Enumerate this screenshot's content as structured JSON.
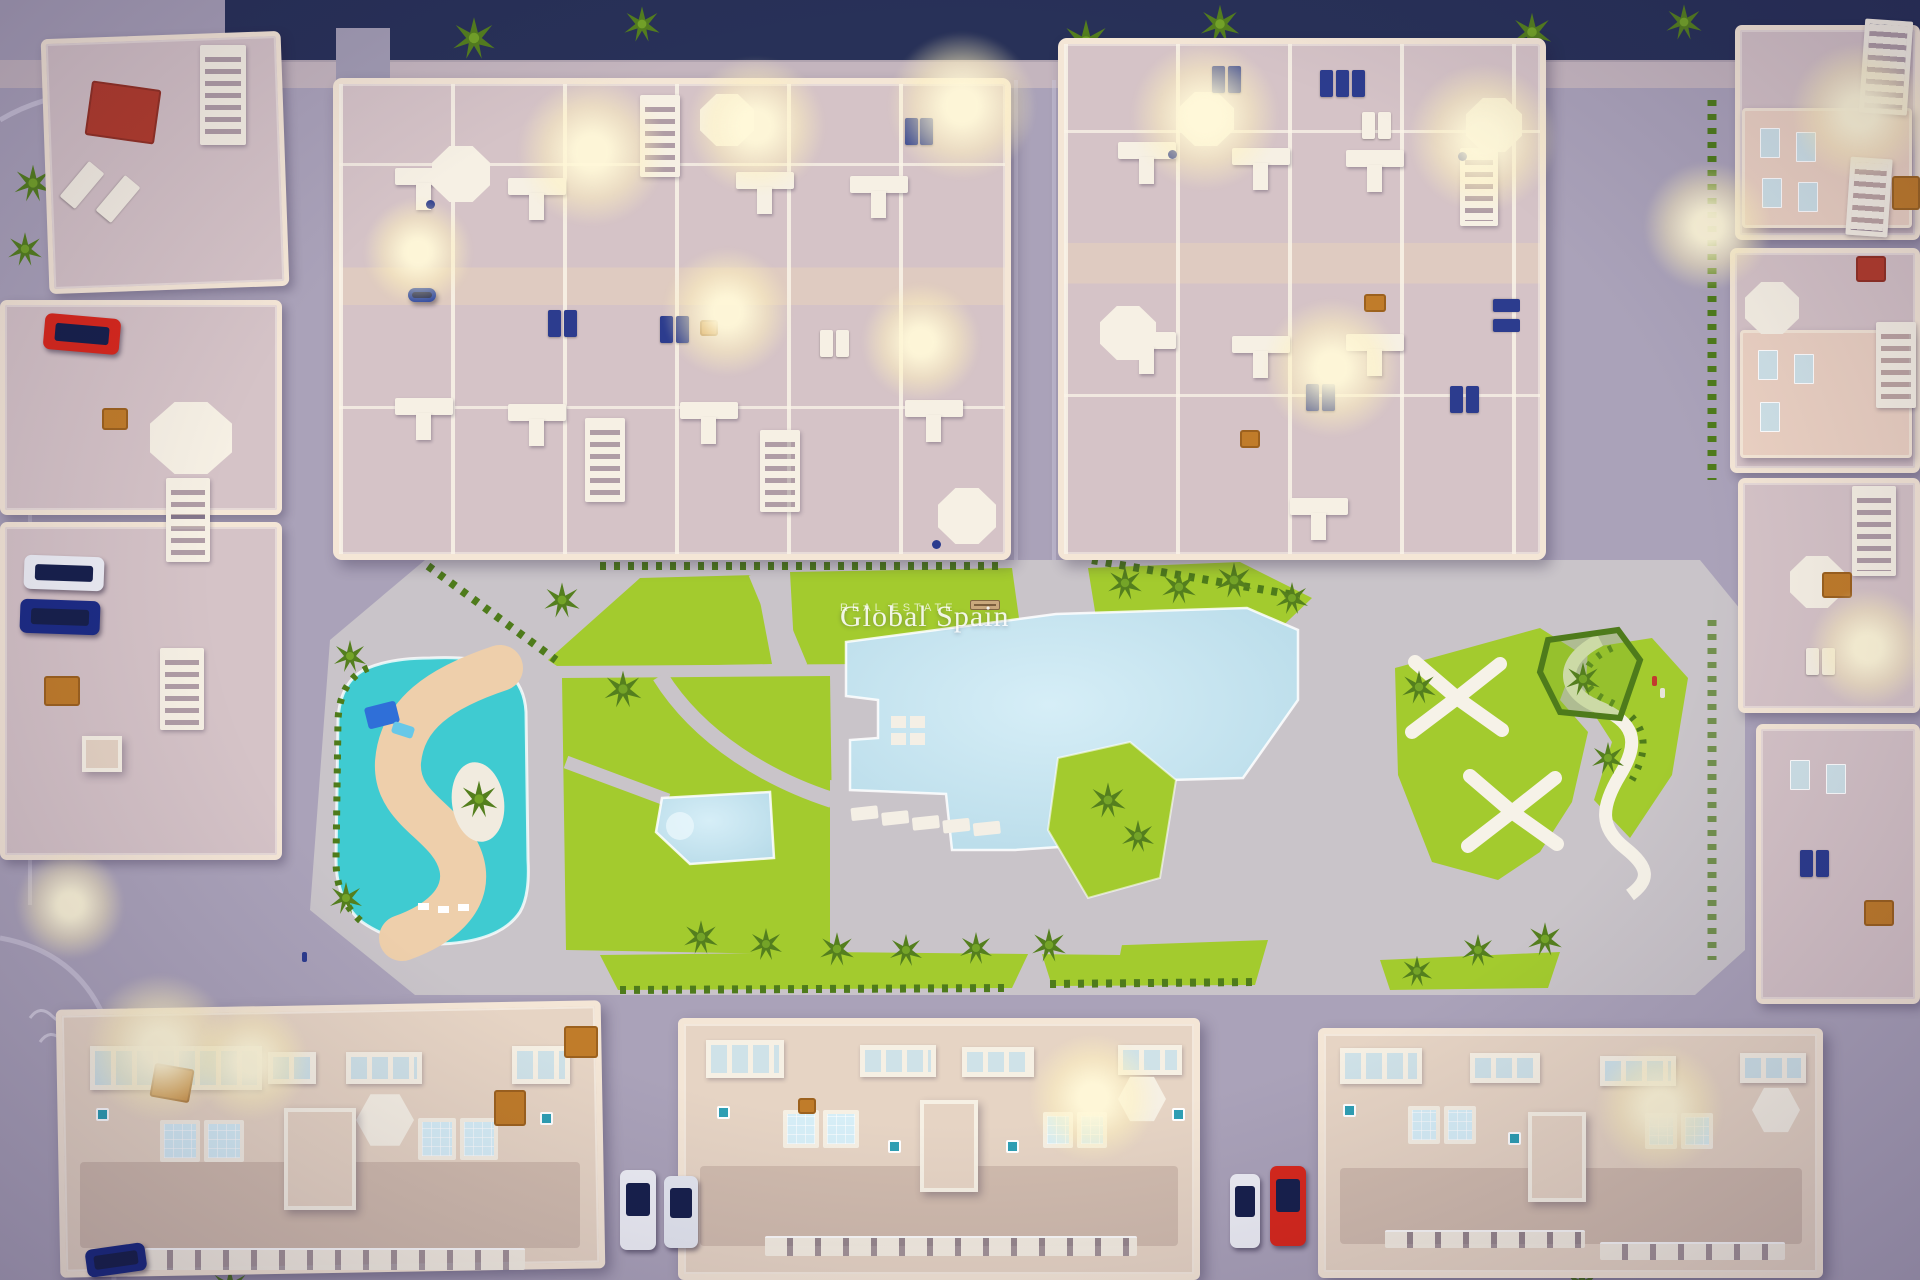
{
  "watermark": {
    "title": "Global Spain",
    "subtitle": "REAL ESTATE"
  },
  "colors": {
    "ground": "#a79fb6",
    "street": "#b4abc2",
    "walk": "#c9b9c0",
    "navy_top": "#1d2750",
    "cobble": "#a29cb3",
    "park": "#c9c4c9",
    "lawn": "#a3cb2e",
    "lawn_light": "#b9d644",
    "hedge": "#4e7b1b",
    "tree": "#547f1e",
    "tree_light": "#74a428",
    "pool": "#b6dae8",
    "pool_light": "#d6eef7",
    "splash": "#3fcbd1",
    "sand": "#eecfab",
    "wall": "#f4e6d6",
    "floor": "#d5c3c7",
    "lane": "#dfcbc1",
    "cream": "#e6d4c4",
    "white": "#f6f0e4",
    "glass": "#cfe2e8",
    "navy": "#2c3c8e",
    "teal": "#2e9fb4",
    "orange": "#c07c2a",
    "rug": "#b23c2c",
    "car_red": "#d8281c",
    "car_white": "#edeef5",
    "car_navy": "#1c2c86",
    "glow": "#fff3c6",
    "curb": "#d3cde0"
  }
}
